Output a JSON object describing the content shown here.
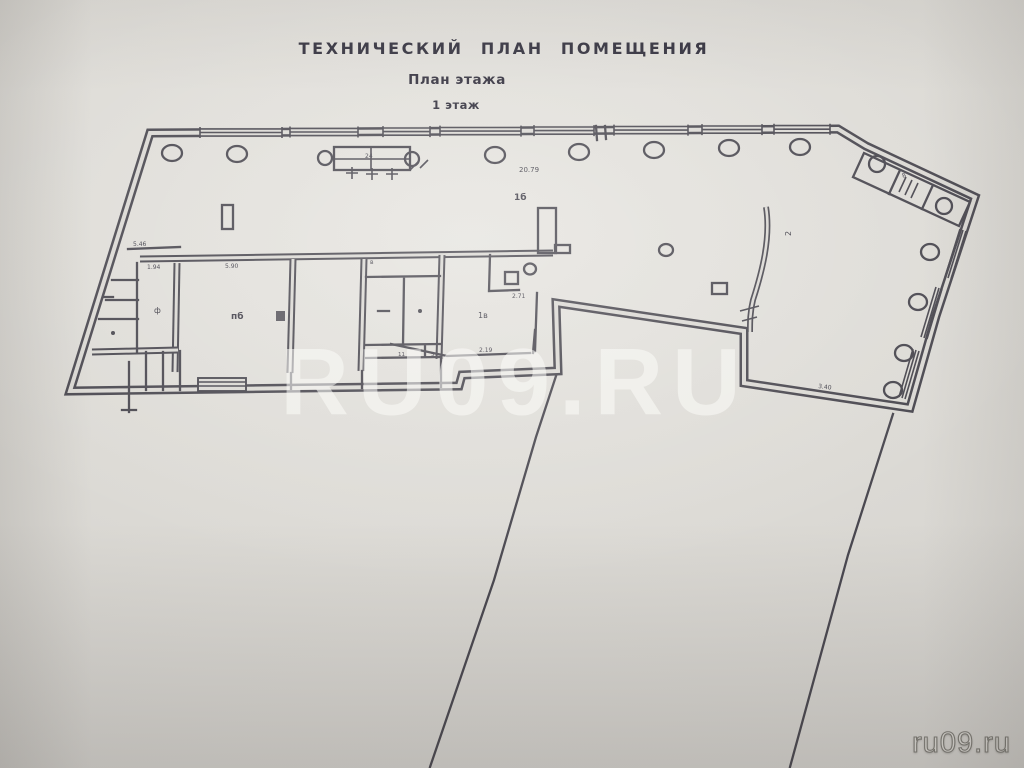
{
  "document": {
    "title": "ТЕХНИЧЕСКИЙ ПЛАН ПОМЕЩЕНИЯ",
    "subtitle": "План этажа",
    "floor": "1 этаж"
  },
  "watermark": {
    "center": "RU09.RU",
    "corner": "ru09.ru"
  },
  "plan": {
    "type": "floor_plan",
    "labels": [
      {
        "text": "20.79"
      },
      {
        "text": "1б"
      },
      {
        "text": "5.46"
      },
      {
        "text": "1.94"
      },
      {
        "text": "5.90"
      },
      {
        "text": "пб"
      },
      {
        "text": "ф"
      },
      {
        "text": "2.71"
      },
      {
        "text": "2.19"
      },
      {
        "text": "11"
      },
      {
        "text": "5"
      },
      {
        "text": "1в"
      },
      {
        "text": "3.40"
      },
      {
        "text": "2"
      },
      {
        "text": "24"
      },
      {
        "text": "в"
      },
      {
        "text": "8"
      }
    ]
  },
  "colors": {
    "paper": "#dbd9d4",
    "ink": "#413f48",
    "watermark_center": "rgba(251,251,248,0.55)",
    "watermark_corner": "#dcdad5"
  }
}
